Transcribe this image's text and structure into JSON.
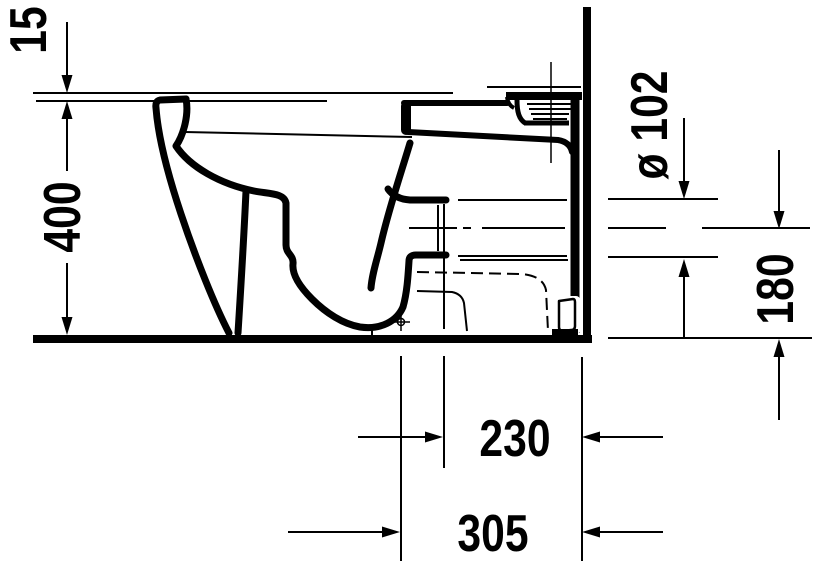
{
  "drawing": {
    "type": "technical-section-drawing",
    "description": "Side section of a floor-standing back-to-wall toilet with horizontal outlet, wall and floor reference lines",
    "background_color": "#ffffff",
    "line_color": "#000000",
    "dimensions": {
      "seat_gap": "15",
      "height": "400",
      "outlet_diameter": "ø 102",
      "outlet_center_height": "180",
      "outlet_face_to_wall": "230",
      "outlet_center_to_wall": "305"
    }
  }
}
